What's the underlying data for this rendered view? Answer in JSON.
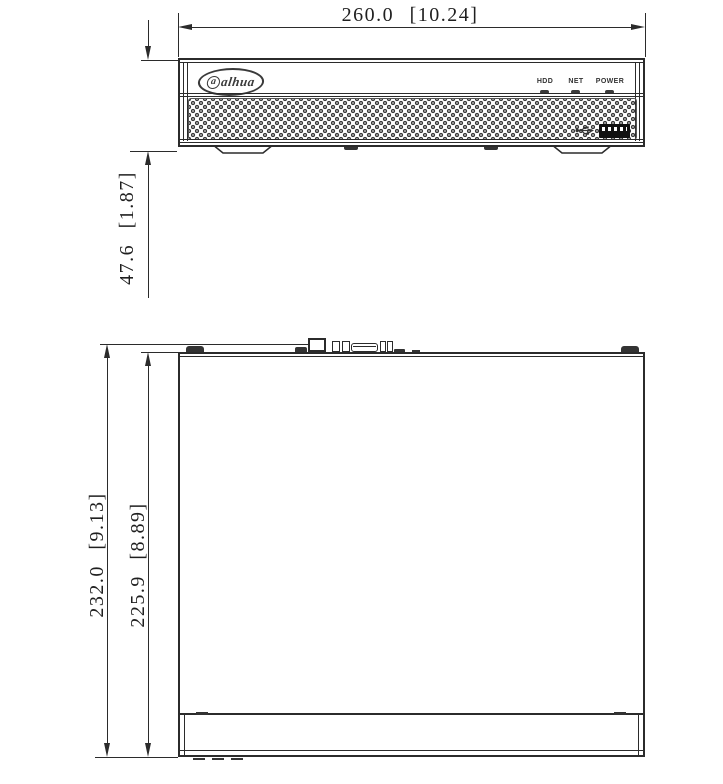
{
  "drawing": {
    "type": "technical-dimension-diagram",
    "front_view": {
      "width_dimension": "260.0 [10.24]",
      "height_dimension": "47.6 [1.87]",
      "brand_logo": "alhua",
      "indicator_labels": [
        "HDD",
        "NET",
        "POWER"
      ]
    },
    "top_view": {
      "overall_depth_dimension": "232.0 [9.13]",
      "body_depth_dimension": "225.9 [8.89]"
    },
    "colors": {
      "line": "#2b2b2b",
      "background": "#ffffff",
      "dark_fill": "#333333"
    }
  }
}
